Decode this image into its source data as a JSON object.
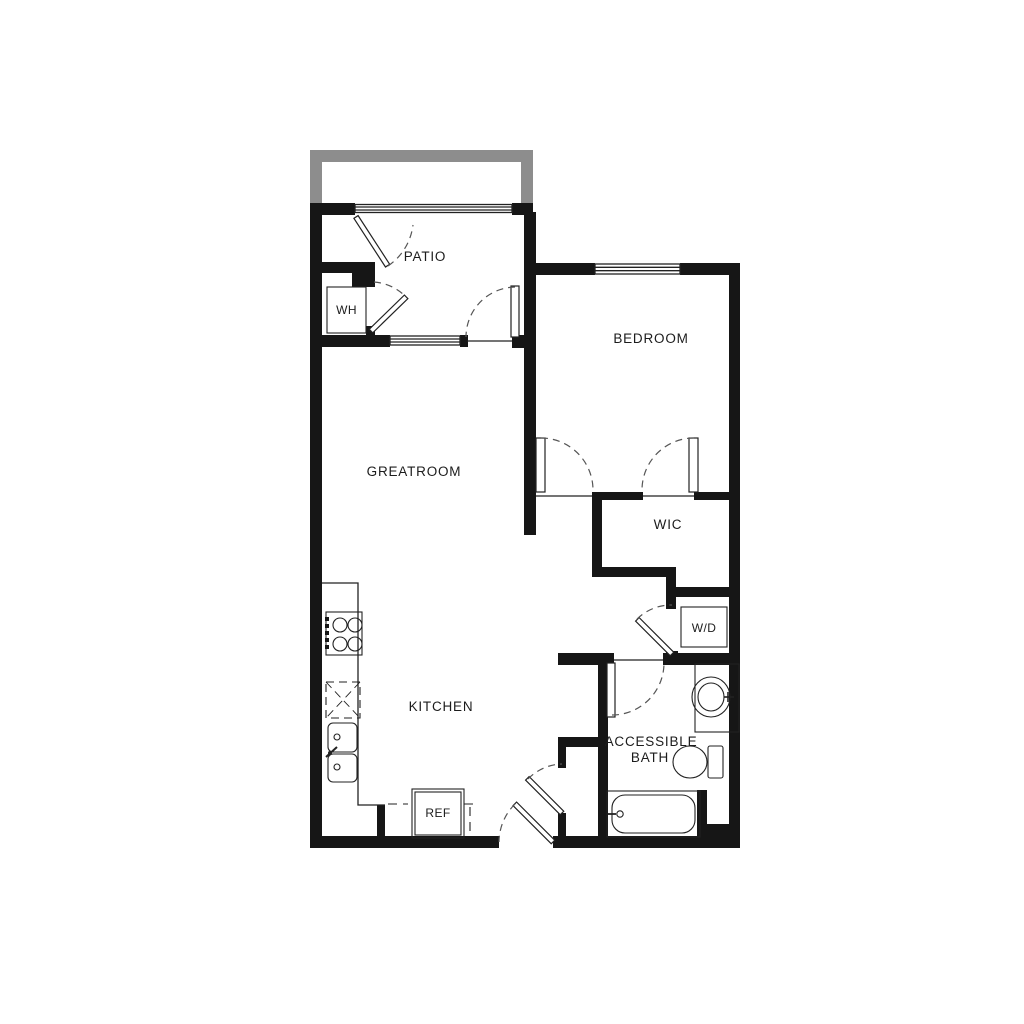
{
  "plan": {
    "title": "one-bedroom floor plan",
    "rooms": {
      "patio": "PATIO",
      "bedroom": "BEDROOM",
      "greatroom": "GREATROOM",
      "wic": "WIC",
      "kitchen": "KITCHEN",
      "bath_line1": "ACCESSIBLE",
      "bath_line2": "BATH"
    },
    "fixtures": {
      "water_heater": "WH",
      "washer_dryer": "W/D",
      "refrigerator": "REF"
    },
    "colors": {
      "wall": "#161616",
      "railing": "#8d8d8d",
      "background": "#ffffff"
    }
  }
}
